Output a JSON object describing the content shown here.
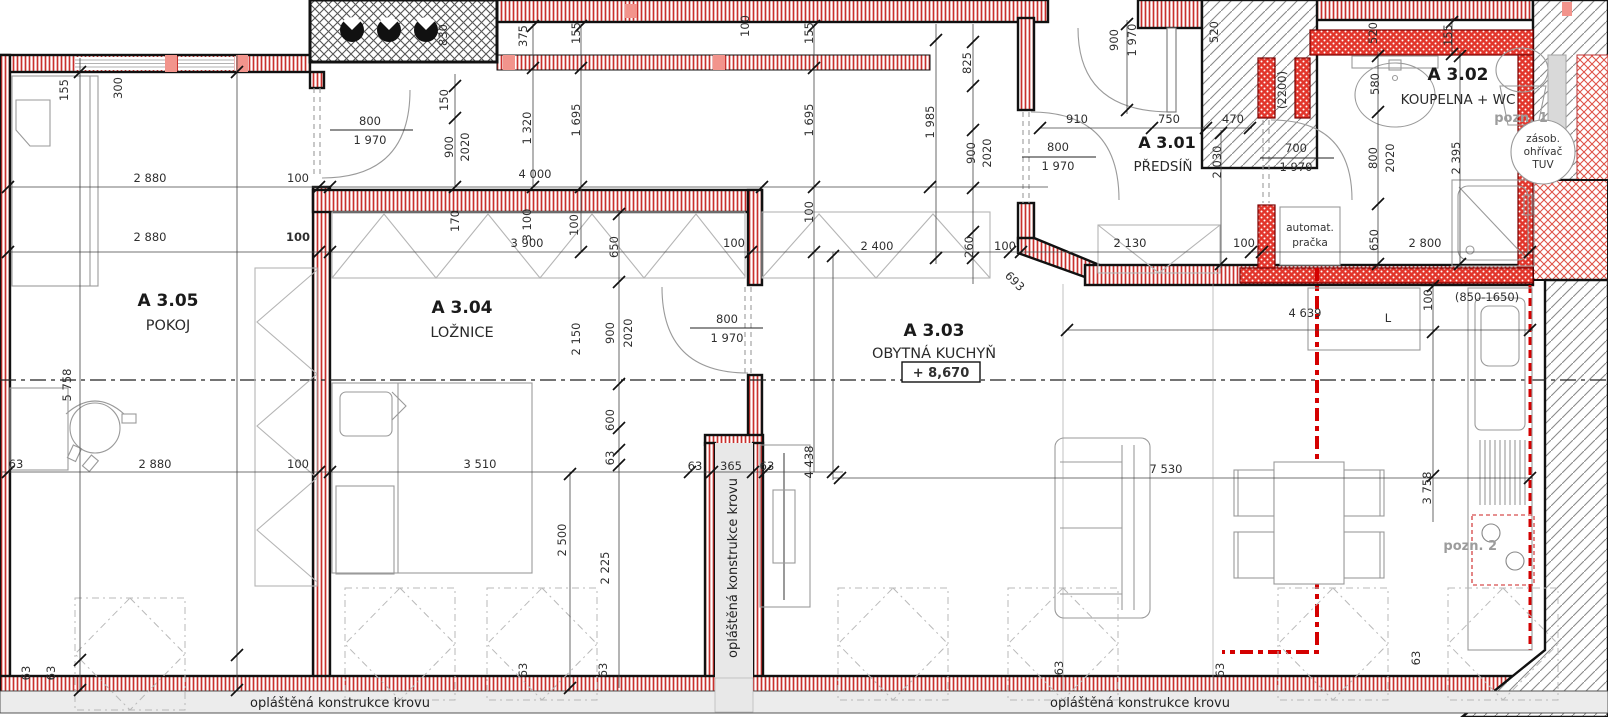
{
  "rooms": [
    {
      "id": "A 3.05",
      "name": "POKOJ"
    },
    {
      "id": "A 3.04",
      "name": "LOŽNICE"
    },
    {
      "id": "A 3.03",
      "name": "OBYTNÁ KUCHYŇ",
      "level": "+ 8,670"
    },
    {
      "id": "A 3.01",
      "name": "PŘEDSÍŇ"
    },
    {
      "id": "A 3.02",
      "name": "KOUPELNA + WC"
    }
  ],
  "notes": {
    "pozn1": "pozn. 1",
    "pozn2": "pozn. 2",
    "heater_l1": "zásob.",
    "heater_l2": "ohřívač",
    "heater_l3": "TUV",
    "washer_l1": "automat.",
    "washer_l2": "pračka",
    "sheathing": "opláštěná konstrukce krovu"
  },
  "colors": {
    "wall_red": "#c9302c",
    "bath_red": "#e2352b",
    "annotation_red": "#cc1111",
    "hatch_gray": "#8a8a8a",
    "furniture_gray": "#9a9a9a"
  },
  "dimensions": [
    {
      "t": "155",
      "x": 68,
      "y": 90,
      "v": 1
    },
    {
      "t": "300",
      "x": 122,
      "y": 88,
      "v": 1
    },
    {
      "t": "150",
      "x": 448,
      "y": 100,
      "v": 1
    },
    {
      "t": "900",
      "x": 453,
      "y": 147,
      "v": 1
    },
    {
      "t": "2020",
      "x": 469,
      "y": 147,
      "v": 1
    },
    {
      "t": "830",
      "x": 447,
      "y": 35,
      "v": 1
    },
    {
      "t": "375",
      "x": 527,
      "y": 36,
      "v": 1
    },
    {
      "t": "1 320",
      "x": 531,
      "y": 128,
      "v": 1
    },
    {
      "t": "155",
      "x": 580,
      "y": 33,
      "v": 1
    },
    {
      "t": "1 695",
      "x": 580,
      "y": 120,
      "v": 1
    },
    {
      "t": "4 000",
      "x": 535,
      "y": 178
    },
    {
      "t": "100",
      "x": 749,
      "y": 26,
      "v": 1
    },
    {
      "t": "155",
      "x": 813,
      "y": 33,
      "v": 1
    },
    {
      "t": "1 695",
      "x": 813,
      "y": 120,
      "v": 1
    },
    {
      "t": "100",
      "x": 813,
      "y": 212,
      "v": 1
    },
    {
      "t": "2 880",
      "x": 150,
      "y": 182
    },
    {
      "t": "100",
      "x": 298,
      "y": 182
    },
    {
      "t": "2 880",
      "x": 150,
      "y": 241
    },
    {
      "t": "100",
      "x": 298,
      "y": 241,
      "b": 1
    },
    {
      "t": "170",
      "x": 459,
      "y": 221,
      "v": 1
    },
    {
      "t": "3 100",
      "x": 531,
      "y": 225,
      "v": 1
    },
    {
      "t": "100",
      "x": 578,
      "y": 225,
      "v": 1
    },
    {
      "t": "3 900",
      "x": 527,
      "y": 247
    },
    {
      "t": "650",
      "x": 618,
      "y": 247,
      "v": 1
    },
    {
      "t": "100",
      "x": 734,
      "y": 247
    },
    {
      "t": "2 400",
      "x": 877,
      "y": 250
    },
    {
      "t": "260",
      "x": 973,
      "y": 247,
      "v": 1
    },
    {
      "t": "100",
      "x": 1005,
      "y": 250
    },
    {
      "t": "2 130",
      "x": 1130,
      "y": 247
    },
    {
      "t": "100",
      "x": 1244,
      "y": 247
    },
    {
      "t": "2 800",
      "x": 1425,
      "y": 247
    },
    {
      "t": "1 985",
      "x": 934,
      "y": 122,
      "v": 1
    },
    {
      "t": "825",
      "x": 971,
      "y": 63,
      "v": 1
    },
    {
      "t": "900",
      "x": 975,
      "y": 153,
      "v": 1
    },
    {
      "t": "2020",
      "x": 991,
      "y": 153,
      "v": 1
    },
    {
      "t": "900",
      "x": 1118,
      "y": 40,
      "v": 1
    },
    {
      "t": "1 970",
      "x": 1136,
      "y": 40,
      "v": 1
    },
    {
      "t": "910",
      "x": 1077,
      "y": 123
    },
    {
      "t": "750",
      "x": 1169,
      "y": 123
    },
    {
      "t": "470",
      "x": 1233,
      "y": 123
    },
    {
      "t": "2 030",
      "x": 1221,
      "y": 162,
      "v": 1
    },
    {
      "t": "520",
      "x": 1218,
      "y": 32,
      "v": 1
    },
    {
      "t": "520",
      "x": 1377,
      "y": 33,
      "v": 1
    },
    {
      "t": "155",
      "x": 1452,
      "y": 35,
      "v": 1
    },
    {
      "t": "580",
      "x": 1379,
      "y": 84,
      "v": 1
    },
    {
      "t": "800",
      "x": 1377,
      "y": 158,
      "v": 1
    },
    {
      "t": "2020",
      "x": 1394,
      "y": 158,
      "v": 1
    },
    {
      "t": "2 395",
      "x": 1460,
      "y": 158,
      "v": 1
    },
    {
      "t": "650",
      "x": 1378,
      "y": 240,
      "v": 1
    },
    {
      "t": "693",
      "x": 1012,
      "y": 284,
      "d": 1
    },
    {
      "t": "2 150",
      "x": 580,
      "y": 339,
      "v": 1
    },
    {
      "t": "900",
      "x": 614,
      "y": 333,
      "v": 1
    },
    {
      "t": "2020",
      "x": 632,
      "y": 333,
      "v": 1
    },
    {
      "t": "600",
      "x": 614,
      "y": 420,
      "v": 1
    },
    {
      "t": "63",
      "x": 614,
      "y": 458,
      "v": 1
    },
    {
      "t": "5 758",
      "x": 71,
      "y": 385,
      "v": 1
    },
    {
      "t": "63",
      "x": 16,
      "y": 468
    },
    {
      "t": "2 880",
      "x": 155,
      "y": 468
    },
    {
      "t": "100",
      "x": 298,
      "y": 468
    },
    {
      "t": "3 510",
      "x": 480,
      "y": 468
    },
    {
      "t": "63",
      "x": 695,
      "y": 470
    },
    {
      "t": "365",
      "x": 731,
      "y": 470
    },
    {
      "t": "63",
      "x": 767,
      "y": 470
    },
    {
      "t": "4 438",
      "x": 813,
      "y": 462,
      "v": 1
    },
    {
      "t": "2 500",
      "x": 566,
      "y": 540,
      "v": 1
    },
    {
      "t": "2 225",
      "x": 609,
      "y": 568,
      "v": 1
    },
    {
      "t": "4 639",
      "x": 1305,
      "y": 317
    },
    {
      "t": "100",
      "x": 1432,
      "y": 300,
      "v": 1
    },
    {
      "t": "7 530",
      "x": 1166,
      "y": 473
    },
    {
      "t": "3 758",
      "x": 1431,
      "y": 488,
      "v": 1
    },
    {
      "t": "63",
      "x": 30,
      "y": 673,
      "v": 1
    },
    {
      "t": "63",
      "x": 55,
      "y": 673,
      "v": 1
    },
    {
      "t": "63",
      "x": 527,
      "y": 670,
      "v": 1
    },
    {
      "t": "63",
      "x": 607,
      "y": 670,
      "v": 1
    },
    {
      "t": "63",
      "x": 1063,
      "y": 668,
      "v": 1
    },
    {
      "t": "63",
      "x": 1224,
      "y": 670,
      "v": 1
    },
    {
      "t": "63",
      "x": 1420,
      "y": 658,
      "v": 1
    },
    {
      "t": "800",
      "x": 370,
      "y": 125
    },
    {
      "t": "1 970",
      "x": 370,
      "y": 144
    },
    {
      "t": "800",
      "x": 727,
      "y": 323
    },
    {
      "t": "1 970",
      "x": 727,
      "y": 342
    },
    {
      "t": "800",
      "x": 1058,
      "y": 151
    },
    {
      "t": "1 970",
      "x": 1058,
      "y": 170
    },
    {
      "t": "700",
      "x": 1296,
      "y": 152
    },
    {
      "t": "1 970",
      "x": 1296,
      "y": 171
    },
    {
      "t": "L",
      "x": 1388,
      "y": 322,
      "c": "#9a9a9a"
    },
    {
      "t": "(2200)",
      "x": 1286,
      "y": 90,
      "v": 1,
      "c": "#cc1111"
    },
    {
      "t": "(850-1650)",
      "x": 1487,
      "y": 301,
      "c": "#cc1111"
    }
  ]
}
